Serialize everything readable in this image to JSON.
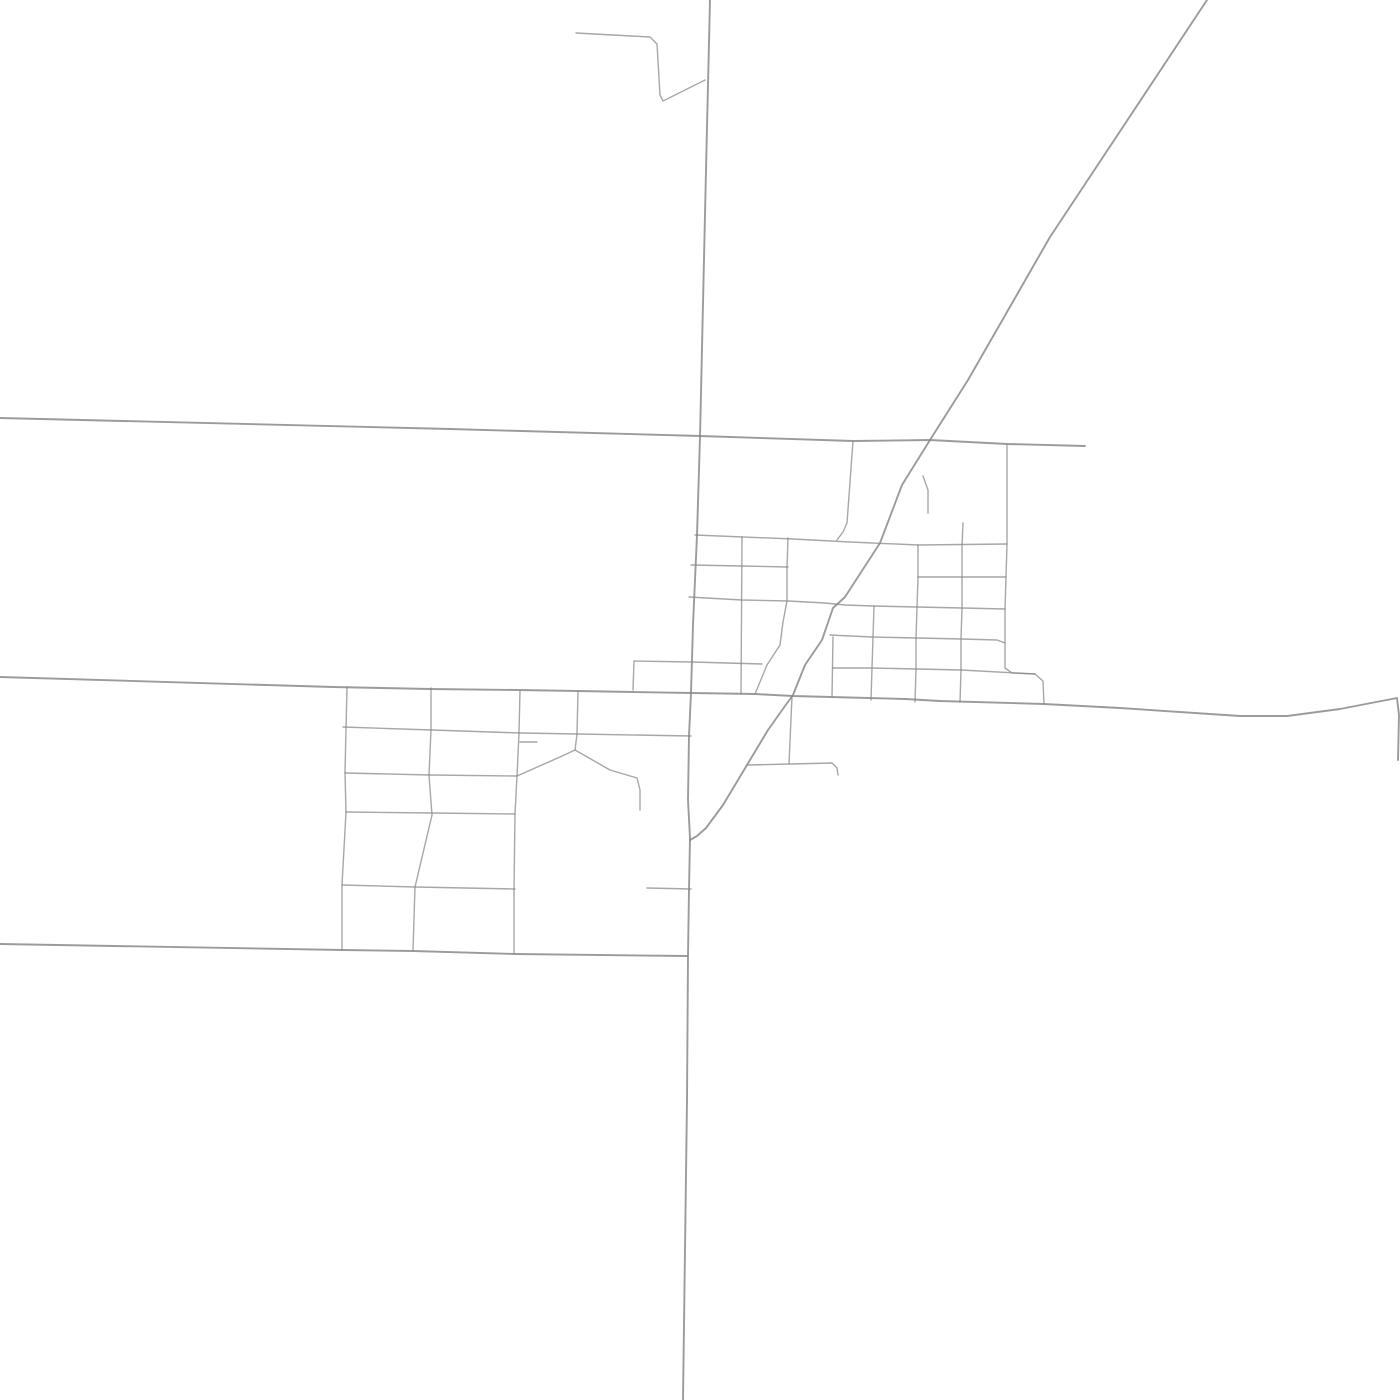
{
  "map": {
    "canvas": {
      "width": 1400,
      "height": 1400,
      "background": "#ffffff"
    },
    "style": {
      "road_color": "#8a8a8a",
      "major_road_width": 1.9,
      "minor_road_width": 1.4,
      "major_road_opacity": 0.85,
      "minor_road_opacity": 0.75
    },
    "roads": [
      {
        "name": "main-north-south-road",
        "major": true,
        "points": [
          [
            710,
            0
          ],
          [
            706,
            170
          ],
          [
            700,
            437
          ],
          [
            697,
            535
          ],
          [
            693,
            625
          ],
          [
            691,
            693
          ],
          [
            689,
            736
          ],
          [
            688,
            800
          ],
          [
            690,
            838
          ],
          [
            689,
            890
          ],
          [
            688,
            956
          ],
          [
            687,
            1100
          ],
          [
            683,
            1400
          ]
        ]
      },
      {
        "name": "northeast-diagonal-road",
        "major": true,
        "points": [
          [
            1207,
            0
          ],
          [
            1050,
            237
          ],
          [
            968,
            380
          ],
          [
            930,
            440
          ],
          [
            902,
            485
          ],
          [
            880,
            543
          ],
          [
            856,
            580
          ],
          [
            845,
            597
          ],
          [
            833,
            608
          ],
          [
            822,
            640
          ],
          [
            805,
            665
          ],
          [
            793,
            695
          ],
          [
            785,
            706
          ],
          [
            768,
            730
          ],
          [
            747,
            765
          ],
          [
            723,
            805
          ],
          [
            706,
            828
          ],
          [
            697,
            836
          ],
          [
            690,
            840
          ]
        ]
      },
      {
        "name": "north-east-west-road",
        "major": true,
        "points": [
          [
            0,
            418
          ],
          [
            450,
            429
          ],
          [
            700,
            436
          ],
          [
            853,
            441
          ],
          [
            930,
            440
          ],
          [
            1007,
            444
          ],
          [
            1085,
            446
          ]
        ]
      },
      {
        "name": "central-east-west-road",
        "major": true,
        "points": [
          [
            0,
            677
          ],
          [
            333,
            687
          ],
          [
            430,
            689
          ],
          [
            518,
            690
          ],
          [
            578,
            691
          ],
          [
            633,
            692
          ],
          [
            692,
            693
          ],
          [
            755,
            694
          ],
          [
            793,
            696
          ],
          [
            868,
            698
          ],
          [
            905,
            699
          ],
          [
            940,
            701
          ],
          [
            1044,
            704
          ],
          [
            1120,
            708
          ],
          [
            1240,
            716
          ],
          [
            1287,
            716
          ],
          [
            1340,
            709
          ],
          [
            1397,
            698
          ],
          [
            1399,
            715
          ],
          [
            1398,
            760
          ]
        ]
      },
      {
        "name": "south-east-west-road",
        "major": true,
        "points": [
          [
            0,
            944
          ],
          [
            343,
            950
          ],
          [
            413,
            951
          ],
          [
            515,
            954
          ],
          [
            687,
            956
          ]
        ]
      },
      {
        "name": "top-hook-road",
        "major": false,
        "points": [
          [
            576,
            33
          ],
          [
            650,
            37
          ],
          [
            657,
            44
          ],
          [
            660,
            95
          ],
          [
            663,
            101
          ],
          [
            705,
            80
          ]
        ]
      },
      {
        "name": "street-y545",
        "major": false,
        "points": [
          [
            695,
            535
          ],
          [
            793,
            539
          ],
          [
            850,
            542
          ],
          [
            918,
            545
          ],
          [
            1007,
            544
          ]
        ]
      },
      {
        "name": "leaning-connector-x850",
        "major": false,
        "points": [
          [
            853,
            441
          ],
          [
            847,
            523
          ],
          [
            843,
            532
          ],
          [
            837,
            540
          ]
        ]
      },
      {
        "name": "diagonal-hook-spur",
        "major": false,
        "points": [
          [
            923,
            476
          ],
          [
            928,
            490
          ],
          [
            928,
            513
          ]
        ]
      },
      {
        "name": "street-y565",
        "major": false,
        "points": [
          [
            691,
            565
          ],
          [
            742,
            566
          ],
          [
            788,
            567
          ]
        ]
      },
      {
        "name": "street-y600",
        "major": false,
        "points": [
          [
            689,
            597
          ],
          [
            742,
            600
          ],
          [
            788,
            601
          ],
          [
            825,
            603
          ],
          [
            845,
            605
          ],
          [
            873,
            606
          ],
          [
            917,
            607
          ],
          [
            962,
            608
          ],
          [
            1005,
            609
          ]
        ]
      },
      {
        "name": "street-y638",
        "major": false,
        "points": [
          [
            830,
            635
          ],
          [
            872,
            637
          ],
          [
            917,
            638
          ],
          [
            962,
            639
          ],
          [
            997,
            640
          ],
          [
            1005,
            643
          ]
        ]
      },
      {
        "name": "street-y577",
        "major": false,
        "points": [
          [
            918,
            577
          ],
          [
            962,
            577
          ],
          [
            1006,
            577
          ]
        ]
      },
      {
        "name": "street-y668",
        "major": false,
        "points": [
          [
            833,
            668
          ],
          [
            872,
            668
          ],
          [
            917,
            669
          ],
          [
            961,
            670
          ],
          [
            1035,
            674
          ]
        ]
      },
      {
        "name": "vertical-x1007-with-elbow",
        "major": false,
        "points": [
          [
            1007,
            444
          ],
          [
            1007,
            544
          ],
          [
            1006,
            577
          ],
          [
            1005,
            609
          ],
          [
            1005,
            643
          ],
          [
            1005,
            668
          ],
          [
            1012,
            673
          ],
          [
            1035,
            674
          ],
          [
            1043,
            681
          ],
          [
            1044,
            704
          ]
        ]
      },
      {
        "name": "notch-street-y660",
        "major": false,
        "points": [
          [
            633,
            690
          ],
          [
            634,
            661
          ],
          [
            692,
            662
          ],
          [
            762,
            664
          ]
        ]
      },
      {
        "name": "vertical-x742",
        "major": false,
        "points": [
          [
            742,
            537
          ],
          [
            741,
            694
          ]
        ]
      },
      {
        "name": "vertical-x788-curving-southwest",
        "major": false,
        "points": [
          [
            788,
            538
          ],
          [
            787,
            567
          ],
          [
            787,
            601
          ],
          [
            783,
            622
          ],
          [
            780,
            645
          ],
          [
            767,
            665
          ],
          [
            755,
            694
          ]
        ]
      },
      {
        "name": "vertical-x833",
        "major": false,
        "points": [
          [
            833,
            637
          ],
          [
            832,
            697
          ]
        ]
      },
      {
        "name": "vertical-x872",
        "major": false,
        "points": [
          [
            874,
            606
          ],
          [
            872,
            668
          ],
          [
            871,
            700
          ]
        ]
      },
      {
        "name": "vertical-x917",
        "major": false,
        "points": [
          [
            918,
            545
          ],
          [
            918,
            577
          ],
          [
            916,
            638
          ],
          [
            916,
            669
          ],
          [
            915,
            702
          ]
        ]
      },
      {
        "name": "vertical-x962",
        "major": false,
        "points": [
          [
            963,
            523
          ],
          [
            962,
            546
          ],
          [
            962,
            577
          ],
          [
            962,
            608
          ],
          [
            961,
            639
          ],
          [
            961,
            670
          ],
          [
            960,
            702
          ]
        ]
      },
      {
        "name": "street-y764-with-hook",
        "major": false,
        "points": [
          [
            747,
            765
          ],
          [
            790,
            764
          ],
          [
            832,
            763
          ],
          [
            837,
            768
          ],
          [
            838,
            775
          ]
        ]
      },
      {
        "name": "vertical-x790",
        "major": false,
        "points": [
          [
            792,
            696
          ],
          [
            789,
            764
          ]
        ]
      },
      {
        "name": "southwest-row-y730",
        "major": false,
        "points": [
          [
            343,
            727
          ],
          [
            432,
            730
          ],
          [
            520,
            733
          ],
          [
            578,
            734
          ],
          [
            691,
            736
          ]
        ]
      },
      {
        "name": "southwest-row-y775-tent",
        "major": false,
        "points": [
          [
            345,
            773
          ],
          [
            430,
            775
          ],
          [
            517,
            776
          ],
          [
            560,
            757
          ],
          [
            575,
            750
          ],
          [
            610,
            770
          ],
          [
            637,
            778
          ],
          [
            640,
            790
          ],
          [
            640,
            810
          ]
        ]
      },
      {
        "name": "southwest-row-y813",
        "major": false,
        "points": [
          [
            346,
            812
          ],
          [
            432,
            813
          ],
          [
            515,
            814
          ]
        ]
      },
      {
        "name": "southwest-row-y887",
        "major": false,
        "points": [
          [
            342,
            885
          ],
          [
            415,
            887
          ],
          [
            515,
            889
          ]
        ]
      },
      {
        "name": "vertical-x345",
        "major": false,
        "points": [
          [
            347,
            687
          ],
          [
            345,
            773
          ],
          [
            346,
            812
          ],
          [
            342,
            885
          ],
          [
            342,
            950
          ]
        ]
      },
      {
        "name": "vertical-x429-leaning",
        "major": false,
        "points": [
          [
            431,
            688
          ],
          [
            431,
            730
          ],
          [
            429,
            775
          ],
          [
            432,
            815
          ],
          [
            415,
            887
          ],
          [
            413,
            950
          ]
        ]
      },
      {
        "name": "vertical-x518",
        "major": false,
        "points": [
          [
            520,
            691
          ],
          [
            519,
            733
          ],
          [
            517,
            776
          ],
          [
            515,
            814
          ],
          [
            514,
            889
          ],
          [
            514,
            953
          ]
        ]
      },
      {
        "name": "vertical-x577-to-apex",
        "major": false,
        "points": [
          [
            578,
            692
          ],
          [
            577,
            734
          ],
          [
            575,
            750
          ]
        ]
      },
      {
        "name": "dead-end-stub-y742",
        "major": false,
        "points": [
          [
            520,
            742
          ],
          [
            537,
            742
          ]
        ]
      },
      {
        "name": "dead-end-spur-y888",
        "major": false,
        "points": [
          [
            647,
            888
          ],
          [
            691,
            889
          ]
        ]
      }
    ]
  }
}
